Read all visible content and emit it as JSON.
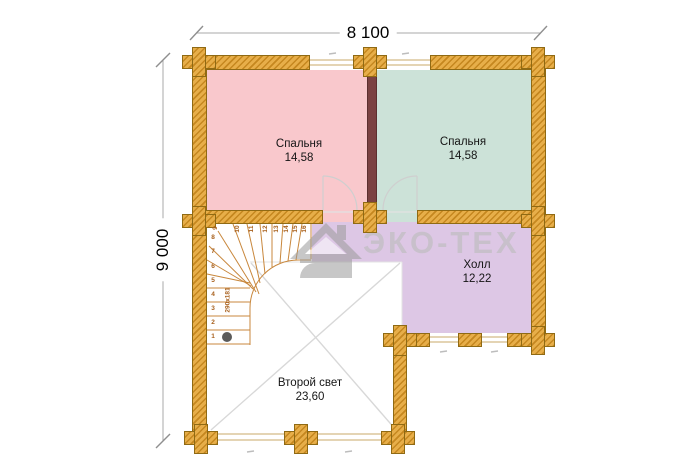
{
  "plan": {
    "type": "floor-plan",
    "dimensions": {
      "top": "8 100",
      "left": "9 000"
    },
    "rooms": {
      "bedroom_left": {
        "name": "Спальня",
        "area": "14,58",
        "color": "#f9c8cc"
      },
      "bedroom_right": {
        "name": "Спальня",
        "area": "14,58",
        "color": "#cce2d8"
      },
      "hall": {
        "name": "Холл",
        "area": "12,22",
        "color": "#ddc7e5"
      },
      "void": {
        "name": "Второй свет",
        "area": "23,60",
        "color": "#ffffff"
      }
    },
    "stairs": {
      "steps": [
        "1",
        "2",
        "3",
        "4",
        "5",
        "6",
        "7",
        "8",
        "9",
        "10",
        "11",
        "12",
        "13",
        "14",
        "15",
        "16"
      ],
      "flight_label": "290х181",
      "start_marker": "start-dot"
    },
    "watermark": {
      "text": "ЭКО-ТЕХ",
      "logo": "house-logo"
    },
    "colors": {
      "wood": "#e7ae49",
      "wood_hatch": "#c5871f",
      "partition": "#7b4242",
      "stair_line": "#c8873c",
      "void_line": "#d8d8d8",
      "dimension_line": "#a9a9a9",
      "watermark_gray": "#bbbbbb"
    }
  }
}
